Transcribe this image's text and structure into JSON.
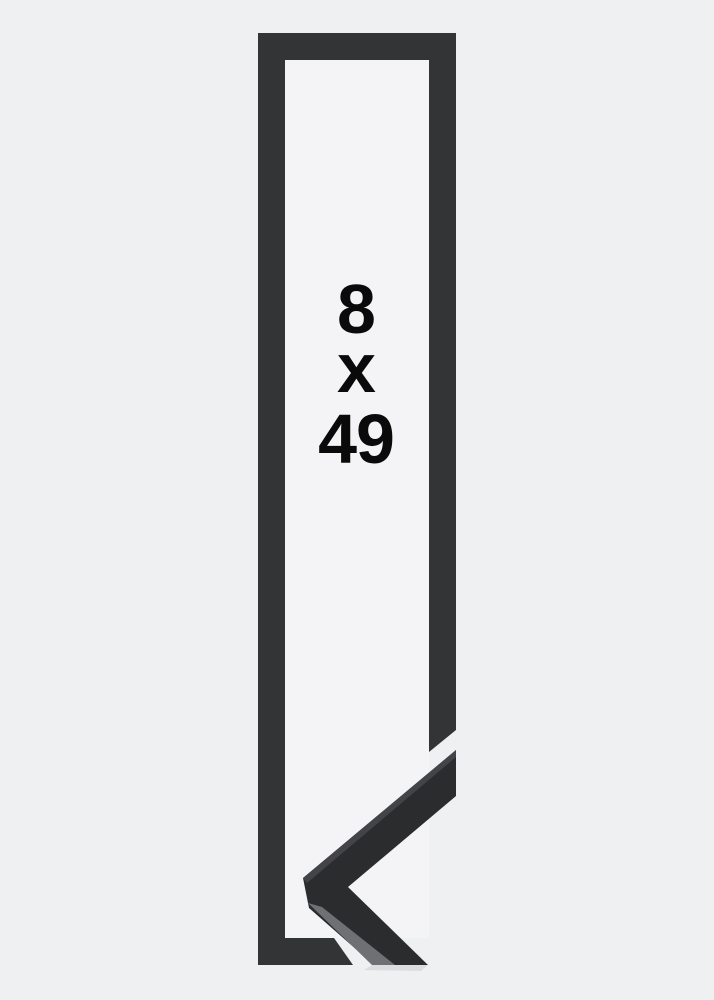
{
  "product_image": {
    "size_label": {
      "width": "8",
      "separator": "x",
      "height": "49"
    },
    "colors": {
      "background": "#eef0f1",
      "frame_moulding": "#333436",
      "frame_opening": "#f4f4f6",
      "corner_sample_face": "#2b2c2e",
      "corner_sample_top_highlight": "#434448",
      "corner_sample_side_face": "#6f7073",
      "corner_sample_shadow": "#d8d9db",
      "label_text": "#0a0a0b"
    }
  }
}
